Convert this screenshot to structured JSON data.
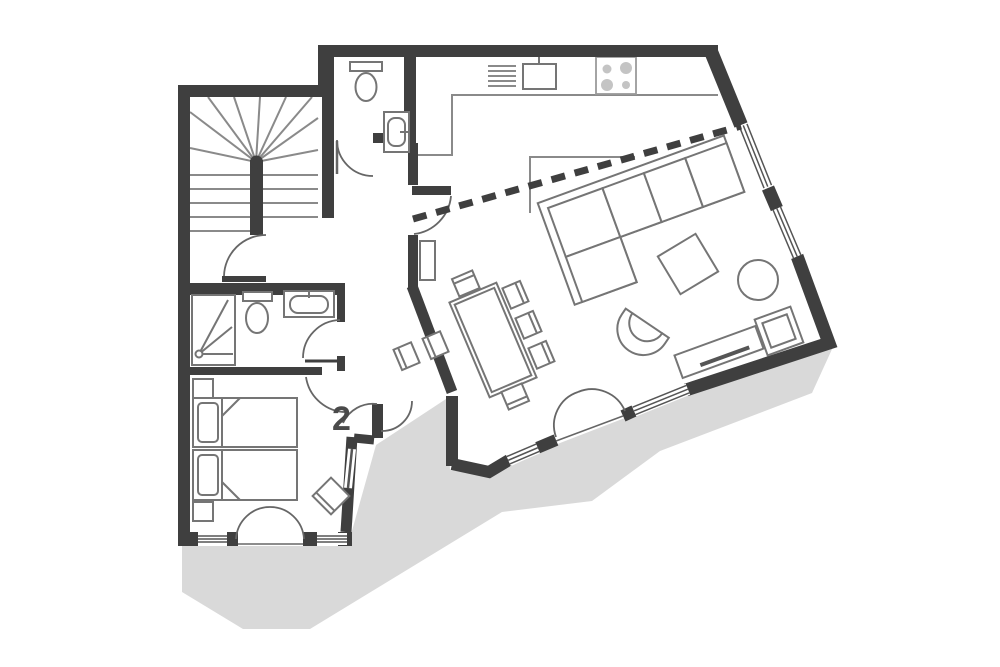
{
  "floorplan": {
    "unit_label": "2",
    "colors": {
      "wall": "#3f3f3f",
      "furniture_line": "#757575",
      "detail_line": "#8a8a8a",
      "terrace": "#d9d9d9",
      "burner": "#c4c4c4",
      "label": "#4a4a4a",
      "background": "#ffffff"
    },
    "rooms": [
      {
        "name": "staircase"
      },
      {
        "name": "wc"
      },
      {
        "name": "kitchen"
      },
      {
        "name": "living-room"
      },
      {
        "name": "dining-area"
      },
      {
        "name": "bathroom"
      },
      {
        "name": "bedroom"
      },
      {
        "name": "terrace"
      }
    ]
  }
}
